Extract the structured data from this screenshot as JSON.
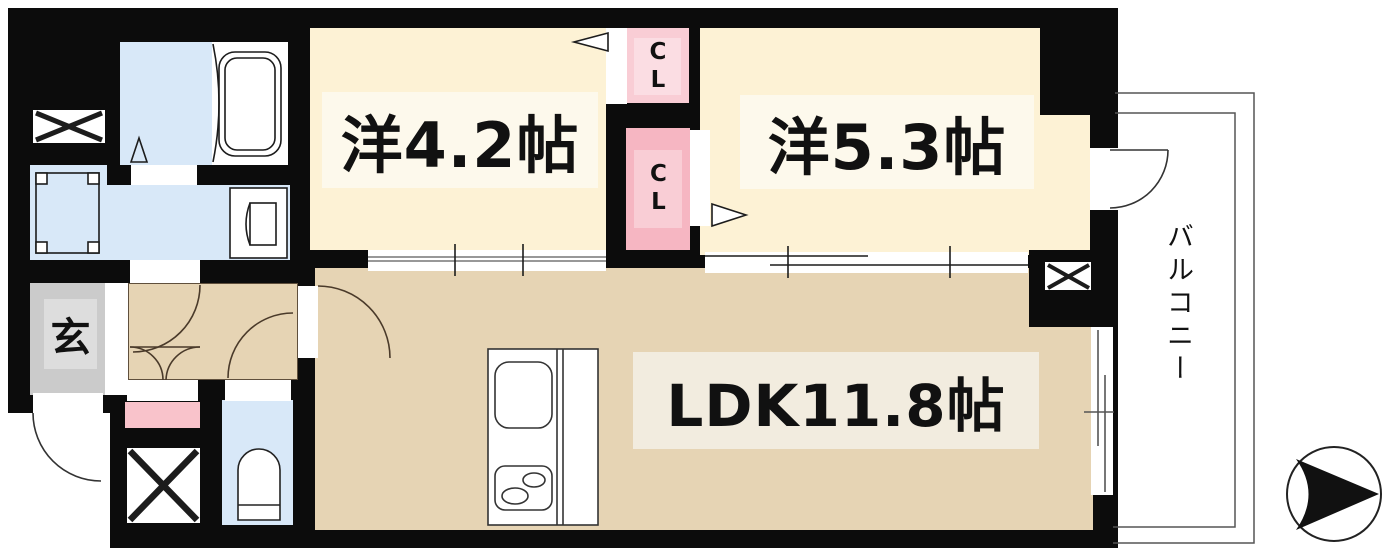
{
  "floorplan": {
    "rooms": {
      "bedroom1": {
        "label": "洋4.2帖"
      },
      "bedroom2": {
        "label": "洋5.3帖"
      },
      "ldk": {
        "label": "LDK11.8帖"
      },
      "entrance": {
        "label": "玄"
      },
      "closet_top": {
        "label": "CL"
      },
      "closet_bottom": {
        "label": "CL"
      },
      "balcony": {
        "label": "バルコニー"
      }
    },
    "colors": {
      "wall": "#0c0c0c",
      "bedroom_fill": "#fdf2d5",
      "bedroom_label_bg": "#fdf9ec",
      "ldk_fill": "#e6d4b4",
      "ldk_label_bg": "#f2ecdf",
      "wet_area_fill": "#d8e8f8",
      "closet_fill": "#f9cdd5",
      "closet_fill_dark": "#f6b6c2",
      "entrance_fill": "#cbcbcb"
    }
  }
}
